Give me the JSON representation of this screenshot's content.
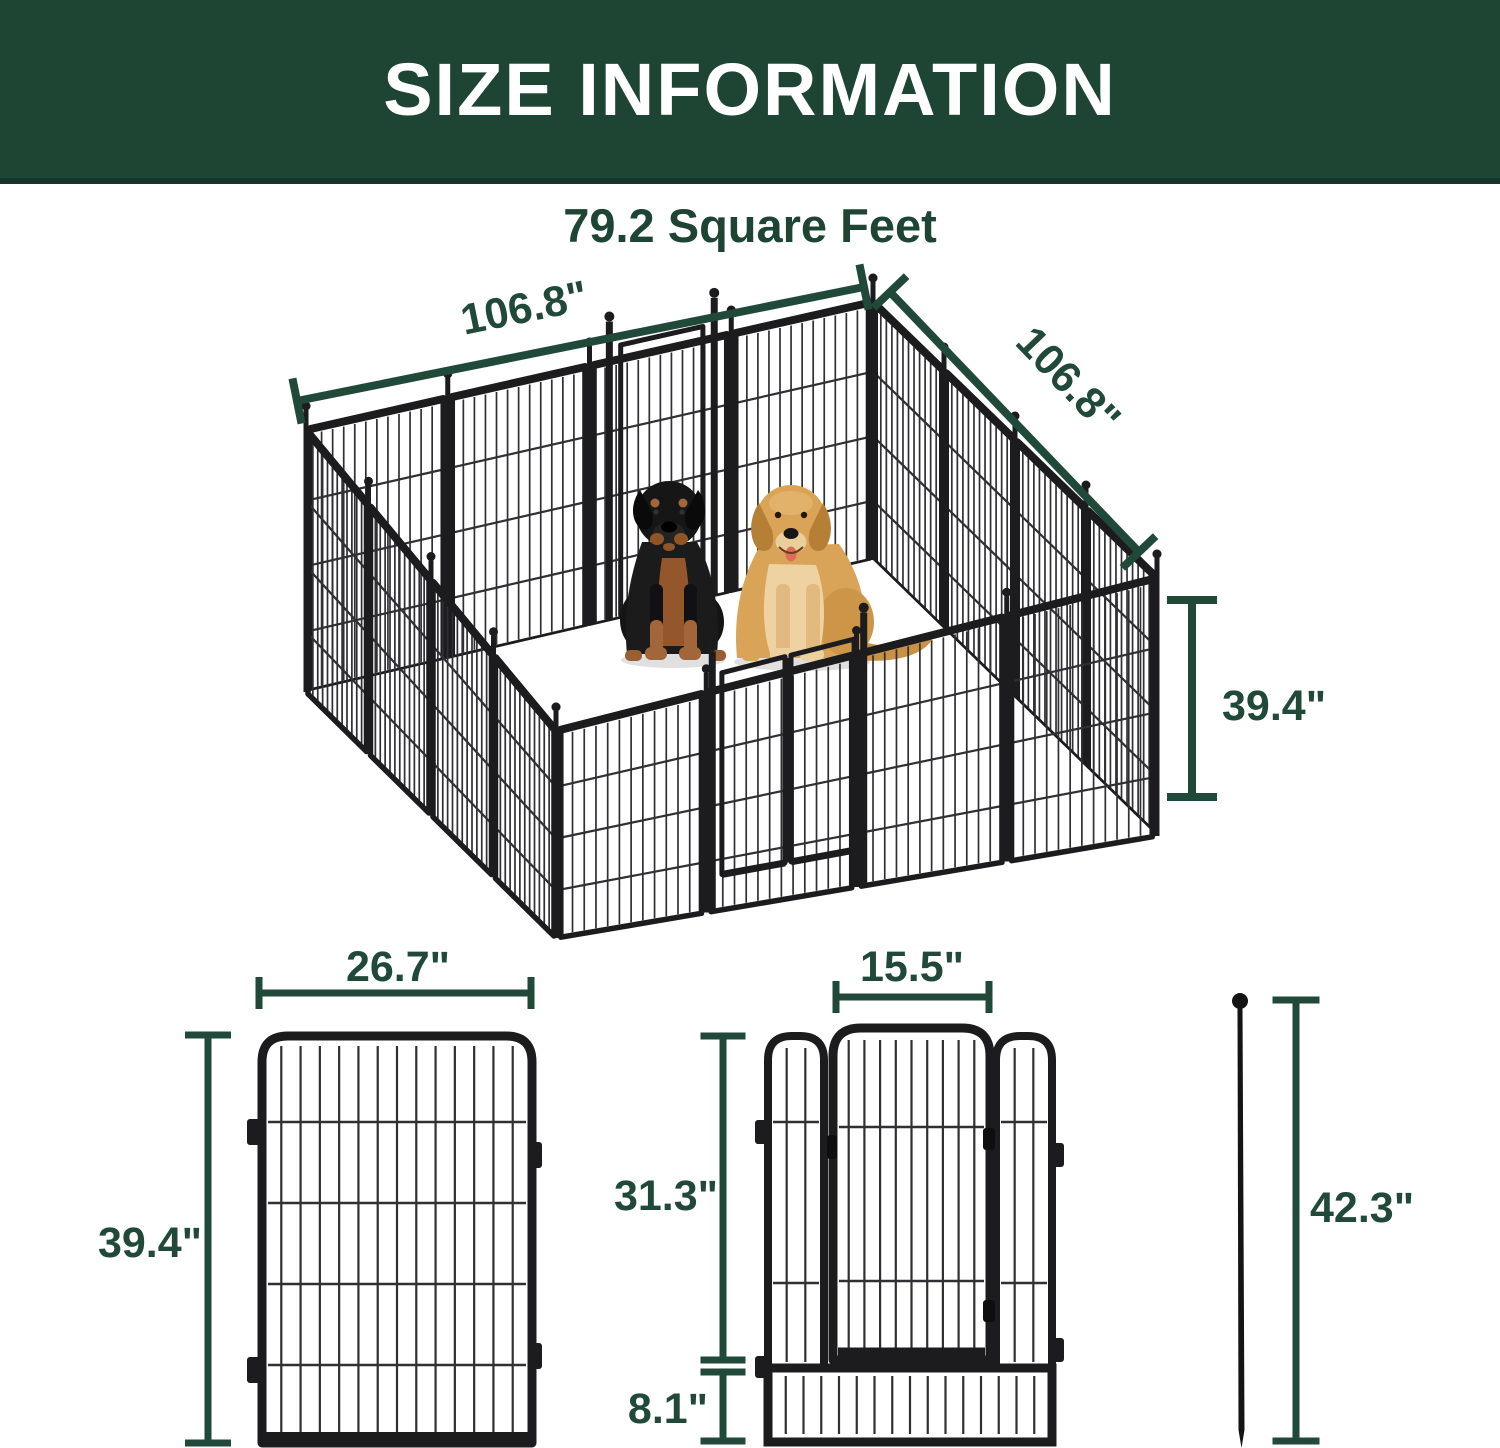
{
  "header": {
    "title": "SIZE INFORMATION"
  },
  "subtitle": "79.2 Square Feet",
  "colors": {
    "banner_green": "#1e4434",
    "banner_edge_green": "#17342a",
    "accent_green": "#21493a",
    "fence_black": "#1b1b1d",
    "rottweiler_coat": "#1a1a1a",
    "golden_retriever_coat": "#d9a458"
  },
  "illustrations": [
    "metal-playpen",
    "rottweiler-dog",
    "golden-retriever-dog",
    "fence-panel",
    "gate-panel",
    "ground-stake"
  ],
  "pen": {
    "side_a_label": "106.8\"",
    "side_b_label": "106.8\"",
    "height_label": "39.4\""
  },
  "panel": {
    "width_label": "26.7\"",
    "height_label": "39.4\""
  },
  "gate": {
    "door_width_label": "15.5\"",
    "upper_height_label": "31.3\"",
    "bottom_section_height_label": "8.1\""
  },
  "stake": {
    "length_label": "42.3\""
  }
}
